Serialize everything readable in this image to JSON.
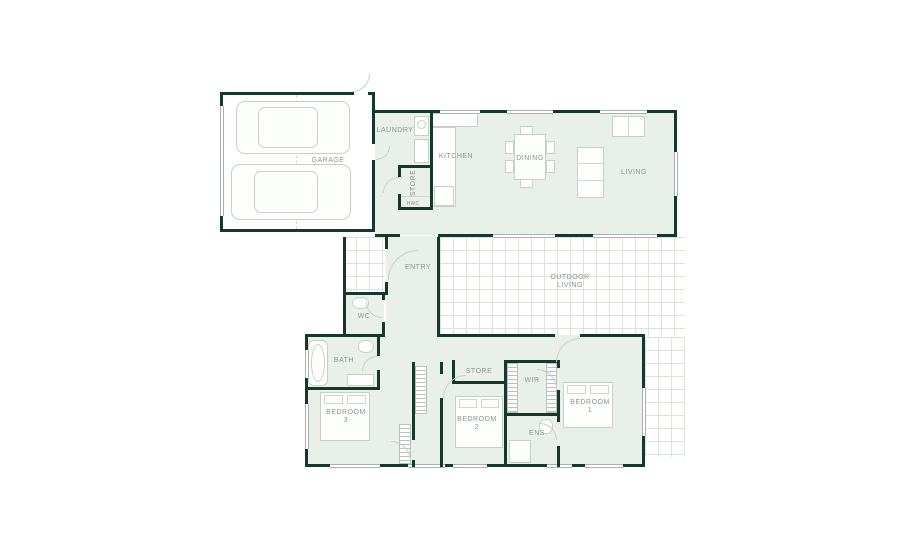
{
  "plan_title": "Single storey house floor plan",
  "colors": {
    "wall": "#16382b",
    "room_fill": "#e9f0e9",
    "tile_line": "#dce3dc",
    "furniture_line": "#c7cfc7",
    "label_text": "#8b948d",
    "background": "#ffffff"
  },
  "rooms": {
    "garage": {
      "label": "GARAGE"
    },
    "laundry": {
      "label": "LAUNDRY"
    },
    "store_hall": {
      "label": "STORE"
    },
    "hwc": {
      "label": "HWC"
    },
    "kitchen": {
      "label": "KITCHEN"
    },
    "dining": {
      "label": "DINING"
    },
    "living": {
      "label": "LIVING"
    },
    "entry": {
      "label": "ENTRY"
    },
    "outdoor_living": {
      "line1": "OUTDOOR",
      "line2": "LIVING"
    },
    "wc": {
      "label": "WC"
    },
    "bath": {
      "label": "BATH"
    },
    "bedroom3": {
      "line1": "BEDROOM",
      "line2": "3"
    },
    "store_bedroom": {
      "label": "STORE"
    },
    "wir": {
      "label": "WIR"
    },
    "bedroom2": {
      "line1": "BEDROOM",
      "line2": "2"
    },
    "ens": {
      "label": "ENS"
    },
    "bedroom1": {
      "line1": "BEDROOM",
      "line2": "1"
    }
  }
}
